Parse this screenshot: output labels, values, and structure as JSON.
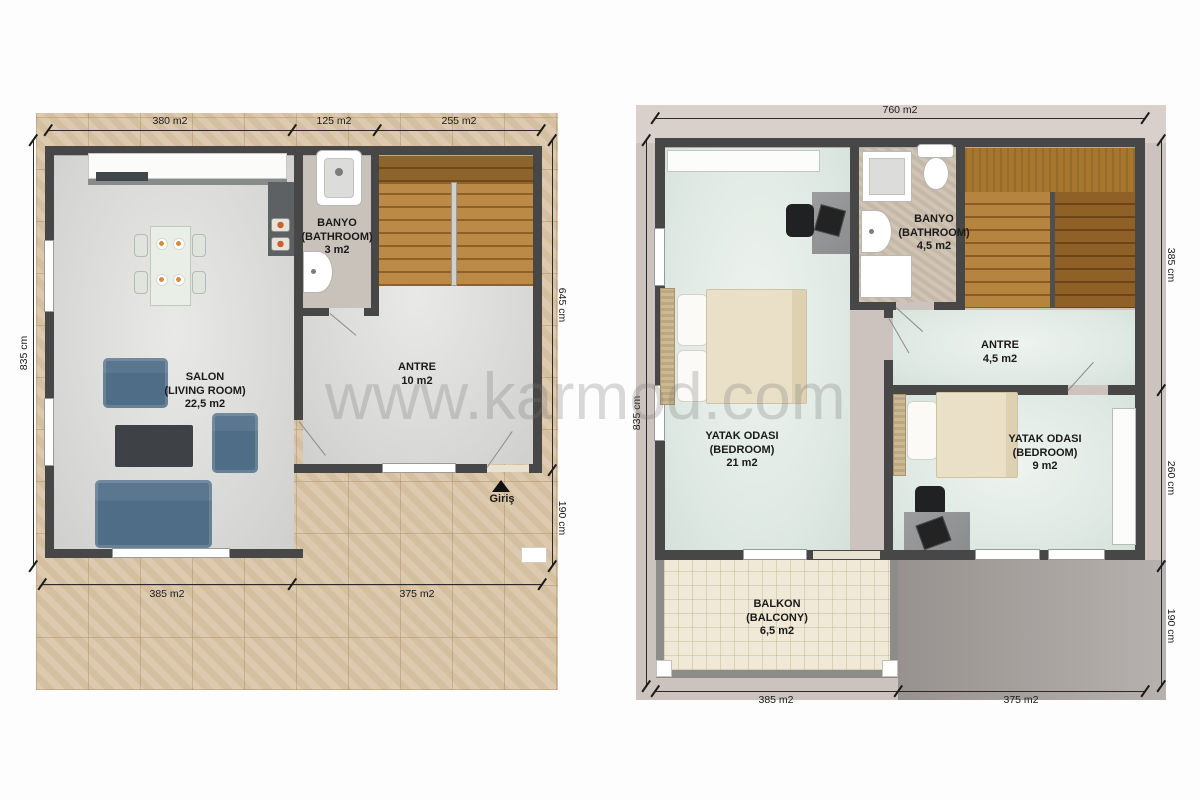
{
  "watermark": "www.karmod.com",
  "palette": {
    "wall": "#474747",
    "wood_tile": "#d9c5a8",
    "stair_wood": "#b5843f",
    "stair_wood_dark": "#8a5c24",
    "ground_interior_floor": "#dcdcda",
    "upper_interior_floor": "#e2eae5",
    "ground_bath_floor": "#c9c2ba",
    "upper_bath_floor": "#cbbead",
    "balcony_floor": "#f0e9d7",
    "upper_background": "#ccc2be",
    "roof_gray": "#a39e9b",
    "sofa_blue": "#4f6d86",
    "bed_cream": "#eae0c7",
    "label_text": "#1a1a1a"
  },
  "ground_floor": {
    "dims": {
      "top": [
        "380 m2",
        "125 m2",
        "255 m2"
      ],
      "left": "835 cm",
      "right": [
        "645 cm",
        "190 cm"
      ],
      "bottom": [
        "385 m2",
        "375 m2"
      ]
    },
    "rooms": {
      "salon": {
        "name": "SALON",
        "alt": "(LIVING ROOM)",
        "area": "22,5 m2"
      },
      "banyo": {
        "name": "BANYO",
        "alt": "(BATHROOM)",
        "area": "3 m2"
      },
      "antre": {
        "name": "ANTRE",
        "area": "10 m2"
      }
    },
    "entrance": "Giriş"
  },
  "upper_floor": {
    "dims": {
      "top": "760 m2",
      "left": "835 cm",
      "right": [
        "385 cm",
        "260 cm",
        "190 cm"
      ],
      "bottom": [
        "385 m2",
        "375 m2"
      ]
    },
    "rooms": {
      "bedroom1": {
        "name": "YATAK ODASI",
        "alt": "(BEDROOM)",
        "area": "21 m2"
      },
      "banyo": {
        "name": "BANYO",
        "alt": "(BATHROOM)",
        "area": "4,5 m2"
      },
      "antre": {
        "name": "ANTRE",
        "area": "4,5 m2"
      },
      "bedroom2": {
        "name": "YATAK ODASI",
        "alt": "(BEDROOM)",
        "area": "9 m2"
      },
      "balkon": {
        "name": "BALKON",
        "alt": "(BALCONY)",
        "area": "6,5 m2"
      }
    }
  }
}
